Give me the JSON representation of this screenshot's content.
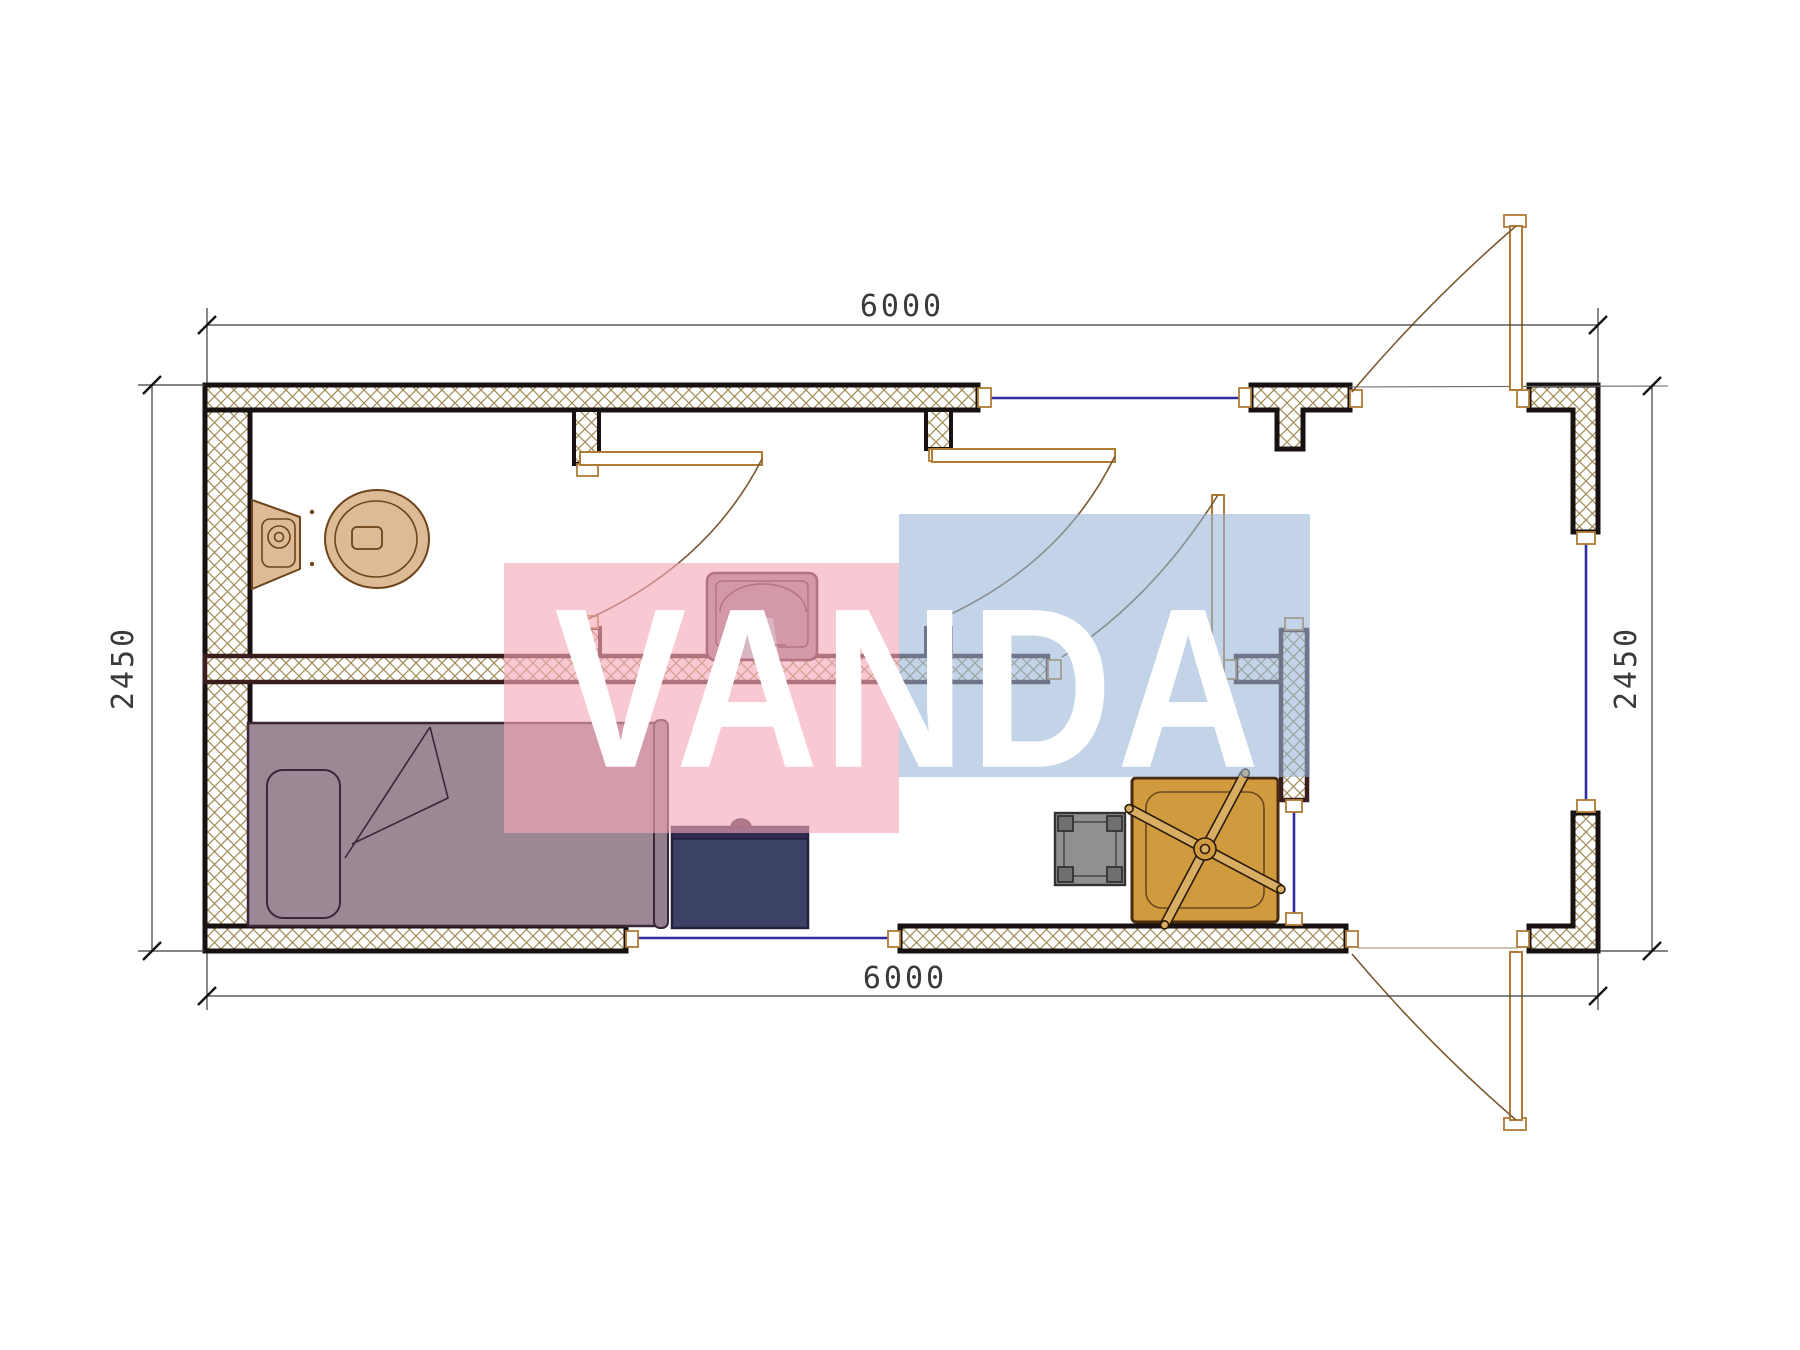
{
  "document": {
    "type": "architectural floor plan",
    "plan_width_mm": "6000",
    "plan_depth_mm": "2450"
  },
  "dimensions": {
    "top": "6000",
    "bottom": "6000",
    "left": "2450",
    "right": "2450"
  },
  "watermark": {
    "text": "VANDA",
    "pink_color": "rgba(246,168,184,0.62)",
    "blue_color": "rgba(151,181,216,0.58)",
    "text_color": "#ffffff"
  },
  "colors": {
    "wall_hatch": "#a08c54",
    "wall_outline": "#171111",
    "inner_wall_outline": "#3a1d1d",
    "window": "#2e2ea0",
    "door_frame": "#b07b34",
    "door_arc": "#7a5a30",
    "toilet": "#dcbb96",
    "toilet_outline": "#6d4418",
    "sink_body": "#9f8190",
    "sink_outline": "#4a1f2e",
    "sink_soap": "#a9ced8",
    "bed": "#9d8795",
    "bed_outline": "#3a2636",
    "desk": "#3c4266",
    "desk_band": "#2e2a50",
    "stool": "#909090",
    "stool_leg": "#707070",
    "table": "#d09b3e",
    "table_outline": "#4a2a10",
    "dimension_line": "#3a3a3a"
  },
  "fixtures": {
    "toilet": "toilet",
    "sink": "wash-basin",
    "bed": "single-bed",
    "desk": "desk-cabinet",
    "stool": "square-stool",
    "fan_table": "table-with-fan"
  }
}
